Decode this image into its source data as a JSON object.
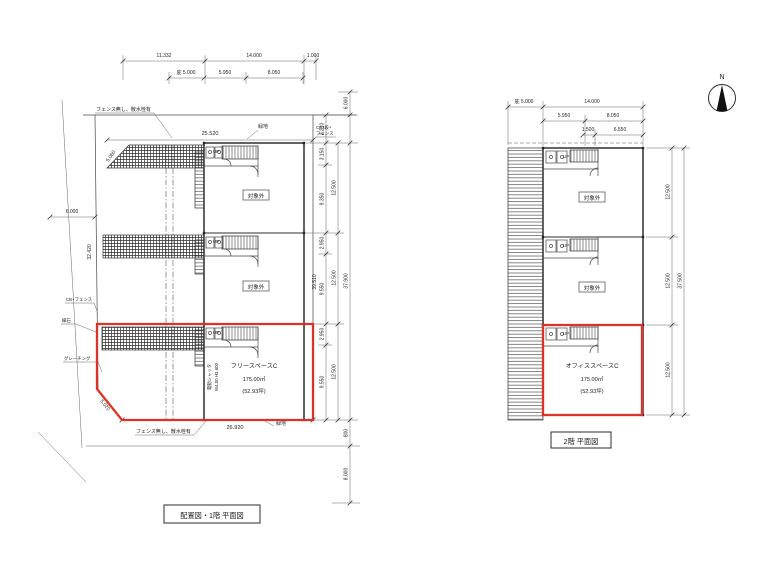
{
  "colors": {
    "red": "#d8342a",
    "line": "#3a3a3a",
    "background": "#ffffff"
  },
  "north": {
    "label": "N"
  },
  "plan1": {
    "caption": "配置図・1階 平面図",
    "t1": [
      "11.332",
      "14.000",
      "1.000"
    ],
    "t2": [
      "庇 5.000",
      "5.950",
      "8.050"
    ],
    "site_north_dim": "25.520",
    "site_south_dim": "26.920",
    "green_north": "緑地",
    "green_south": "緑地",
    "fence_north": "フェンス無し、散水栓有",
    "fence_south": "フェンス無し、散水栓有",
    "cb_east_l1": "CB2段+",
    "cb_east_l2": "フェンス",
    "cb_west": "CB+フェンス",
    "curb": "縁石",
    "grating": "グレーチング",
    "west_road_dim": "6.000",
    "west_boundary_dim": "32.420",
    "corner_cut_dim": "5.020",
    "slant_dim": "5.060",
    "shutter_l1": "電動シャッタ",
    "shutter_l2": "W4.00 H3.600",
    "up": "UP",
    "excluded": "対象外",
    "unit_c": {
      "name": "フリースペースC",
      "area": "175.00㎡",
      "tsubo": "(52.93坪)"
    },
    "east_segments": [
      "3.150",
      "9.350",
      "2.950",
      "9.550",
      "2.950",
      "9.550"
    ],
    "east_units": [
      "12.500",
      "12.500",
      "12.500"
    ],
    "east_total": "37.900",
    "east_wall_len": "39.510",
    "ne_offset": "6.000",
    "ne_offset2": "2.210",
    "south_offset": "800",
    "south_road_dim": "8.000"
  },
  "plan2": {
    "caption": "2階 平面図",
    "t1": [
      "庇 5.000",
      "14.000"
    ],
    "t2": [
      "5.950",
      "8.050"
    ],
    "t3": [
      "1.500",
      "6.550"
    ],
    "up": "UP",
    "excluded": "対象外",
    "unit_c": {
      "name": "オフィススペースC",
      "area": "175.00㎡",
      "tsubo": "(52.93坪)"
    },
    "east_units": [
      "12.500",
      "12.500",
      "12.500"
    ],
    "east_total": "37.500"
  }
}
